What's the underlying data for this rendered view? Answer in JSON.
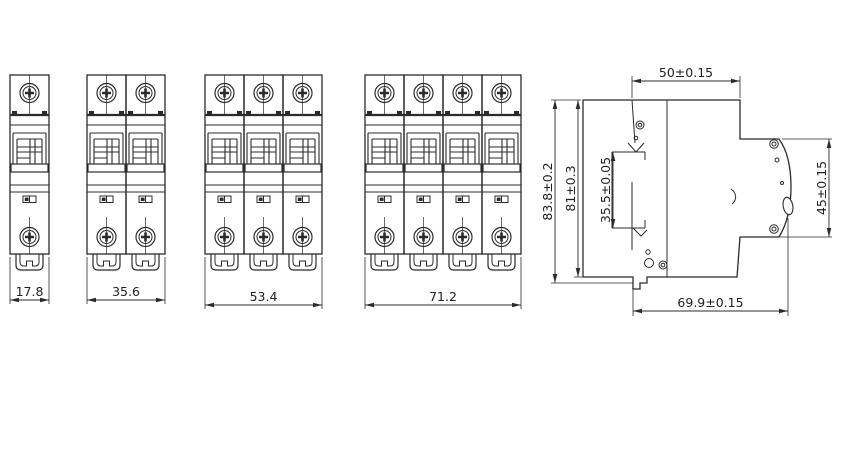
{
  "drawing": {
    "front_views": [
      {
        "poles": 1,
        "width_label": "17.8"
      },
      {
        "poles": 2,
        "width_label": "35.6"
      },
      {
        "poles": 3,
        "width_label": "53.4"
      },
      {
        "poles": 4,
        "width_label": "71.2"
      }
    ],
    "side_view": {
      "top_width_label": "50±0.15",
      "overall_height_label": "83.8±0.2",
      "body_height_label": "81±0.3",
      "din_slot_label": "35.5±0.05",
      "front_face_height_label": "45±0.15",
      "overall_depth_label": "69.9±0.15"
    },
    "line_color": "#2b2b2b",
    "background": "#ffffff"
  }
}
